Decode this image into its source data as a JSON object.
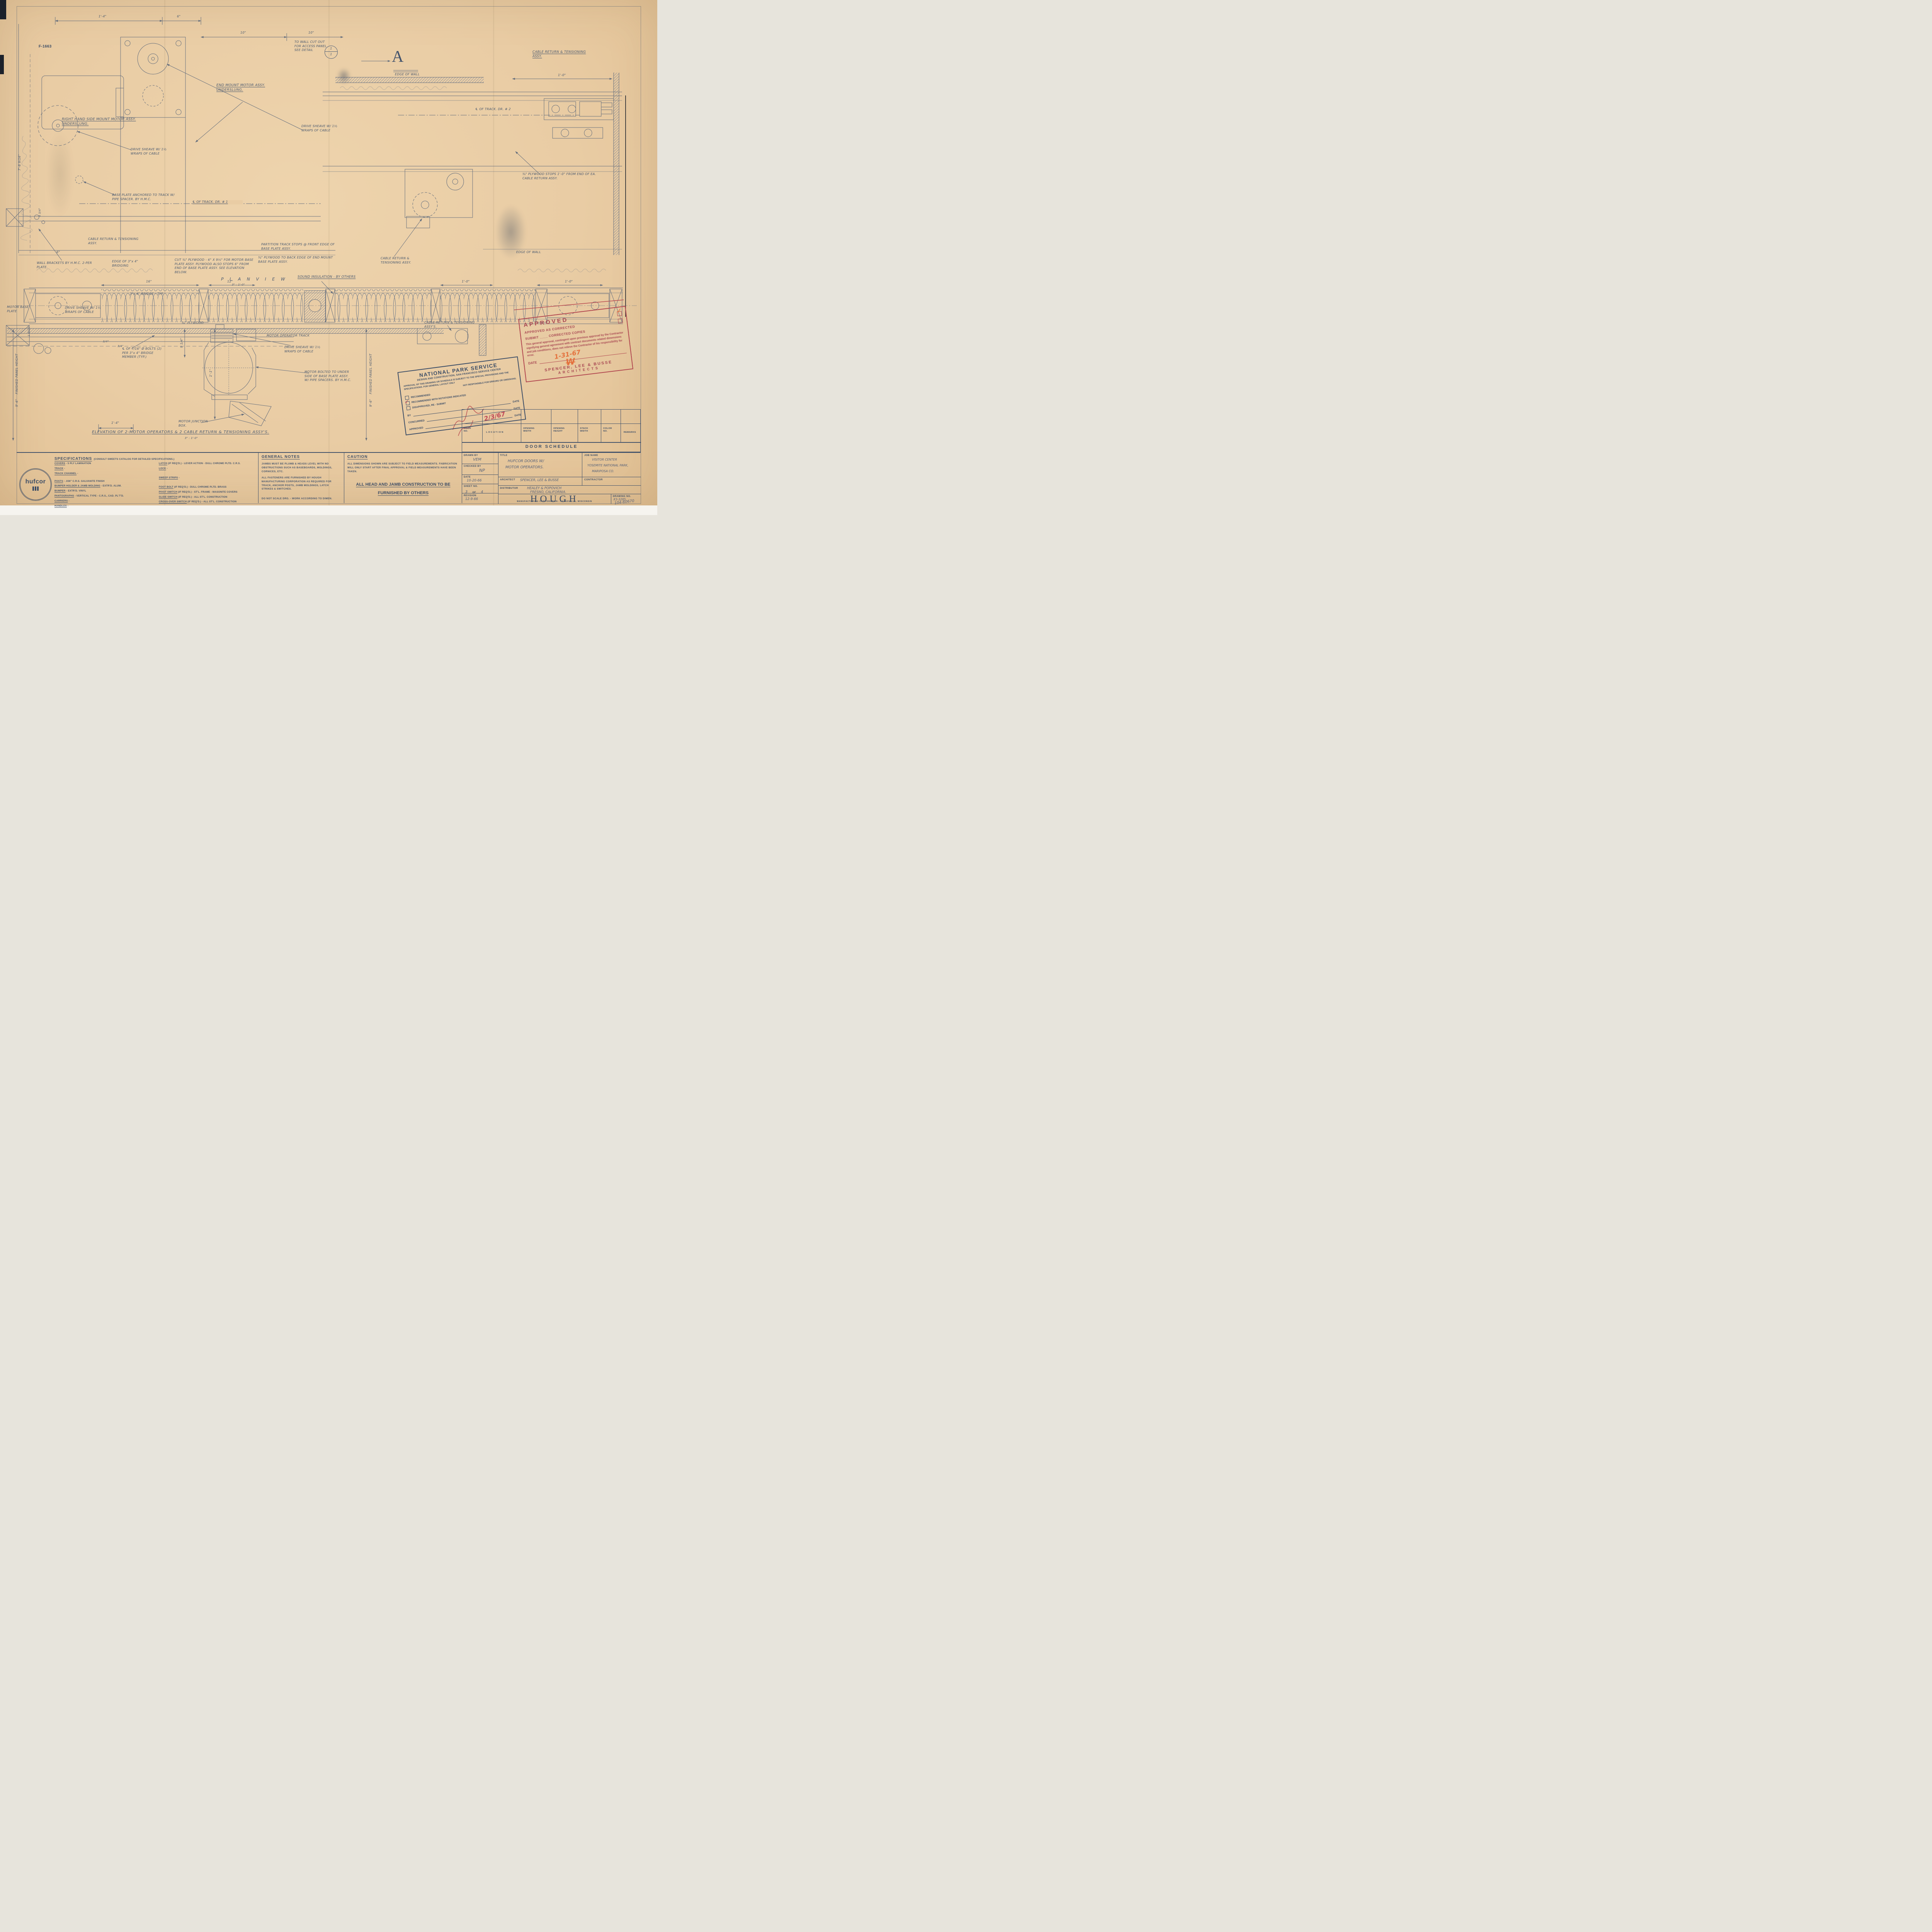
{
  "sheet": {
    "ref_no": "F-1663",
    "section_marker": "A",
    "detail_top": "1",
    "detail_bottom": "1"
  },
  "labels": {
    "rh_mount": "RIGHT HAND SIDE MOUNT MOTOR ASSY. UNDERSLUNG.",
    "end_mount": "END MOUNT MOTOR ASSY. UNDERSLUNG.",
    "wall_cutout": "TO WALL CUT OUT FOR ACCESS PANEL SEE DETAIL",
    "drive_sheave": "DRIVE SHEAVE W/ 1½ WRAPS OF CABLE",
    "edge_of_wall": "EDGE OF WALL",
    "cable_return": "CABLE RETURN & TENSIONING ASSY.",
    "cable_return_pl": "CABLE RETURN & TENSIONING ASSY'S.",
    "base_plate_anchor": "BASE PLATE ANCHORED TO TRACK W/ PIPE SPACER. BY H.M.C.",
    "track_cl1": "℄ OF TRACK. DR. # 1",
    "track_cl2": "℄ OF TRACK. DR. # 2",
    "wall_brackets": "WALL BRACKETS BY H.M.C. 2-PER PLATE.",
    "edge_bridging": "EDGE OF 3\"x 4\" BRIDGING",
    "cut_plywood": "CUT ¾\" PLYWOOD - 6\" X 9½\" FOR MOTOR BASE PLATE ASSY. PLYWOOD ALSO STOPS 6\" FROM END OF BASE PLATE ASSY. SEE ELEVATION BELOW.",
    "partition_stops": "PARTITION TRACK STOPS @ FRONT EDGE OF BASE PLATE ASSY.",
    "plywood_back": "¾\" PLYWOOD TO BACK EDGE OF END MOUNT BASE PLATE ASSY.",
    "plywood_stops": "¾\" PLYWOOD STOPS 1'-0\" FROM END OF EA. CABLE RETURN ASSY.",
    "sound_insulation": "SOUND INSULATION - BY OTHERS",
    "motor_base_plate": "MOTOR BASE PLATE",
    "bridge_typ": "3\"x 4\" BRIDGE - TYP.",
    "plywood34": "¾\" PLYWOOD",
    "bolts_note": "℄ OF 7/16\" Ø BOLTS (2) PER 3\"x 4\" BRIDGE MEMBER (TYP.)",
    "junction_box": "MOTOR JUNCTION BOX.",
    "motor_bolted": "MOTOR BOLTED TO UNDER SIDE OF BASE PLATE ASSY. W/ PIPE SPACERS. BY H.M.C.",
    "motor_track": "MOTOR OPERATOR TRACK",
    "finished_height": "FINISHED PANEL HEIGHT"
  },
  "dims": {
    "d1": "1'-4\"",
    "d2": "6\"",
    "d3": "10\"",
    "d4": "10\"",
    "d5": "1'-0\"",
    "d6": "7'-8 9/16\"",
    "d7": "4 3/4\"",
    "d8": "6\"",
    "d9": "16\"",
    "d10": "12\"",
    "d11": "1'-0\"",
    "d12": "1'-0\"",
    "d13": "9 1/4\"",
    "d14": "1'-1\"",
    "d15": "1'-4\"",
    "d16": "1 9/16\"",
    "d17": "3/4\"",
    "d18": "3/4\"",
    "d19": "9'-6\"",
    "d20": "9'-6\""
  },
  "plan_view": {
    "title": "P L A N    V I E W",
    "scale": "3\" : 1'-0\""
  },
  "elevation": {
    "title": "ELEVATION OF 2-MOTOR OPERATORS & 2 CABLE RETURN & TENSIONING ASSY'S.",
    "scale": "3\" : 1'-0\""
  },
  "nps_stamp": {
    "title": "NATIONAL PARK SERVICE",
    "subtitle": "DESIGN AND CONSTRUCTION, SAN FRANCISCO SERVICE CENTER",
    "body1": "APPROVAL OF THIS DRAWING OR SCHEDULE IS SUBJECT TO THE SPECIAL PROVISIONS AND THE SPECIFICATIONS.   FOR GENERAL LAYOUT ONLY",
    "body2": "NOT RESPONSIBLE FOR ERRORS OR OMISSIONS.",
    "cb1": "RECOMMENDED",
    "cb2": "RECOMMENDED WITH NOTATIONS INDICATED",
    "cb3": "DISAPPROVED, RE - SUBMIT",
    "by_label": "BY",
    "date_label": "DATE",
    "concurred_label": "CONCURRED",
    "approved_label": "APPROVED",
    "red_date": "2/3/67"
  },
  "approval_stamp": {
    "approved": "APPROVED",
    "as_corrected": "APPROVED AS CORRECTED",
    "submit": "SUBMIT ____ CORRECTED COPIES",
    "body": "This general approval, contingent upon previous approval by the Contractor signifying general agreement with contract documents related dimensions and job conditions, does not relieve the Contractor of his responsibility for error.",
    "date_label": "DATE",
    "date_value": "1-31-67",
    "initials": "W",
    "firm": "SPENCER, LEE & BUSSE",
    "firm2": "ARCHITECTS"
  },
  "door_schedule": {
    "title": "DOOR SCHEDULE",
    "col_door": "DOOR\nNO.",
    "col_location": "LOCATION",
    "col_ow": "OPENING\nWIDTH",
    "col_oh": "OPENING\nHEIGHT",
    "col_sw": "STACK\nWIDTH",
    "col_color": "COLOR\nNO.",
    "col_remarks": "REMARKS"
  },
  "title_block": {
    "drawn_by_label": "DRAWN BY",
    "drawn_by": "VEM",
    "checked_by_label": "CHECKED BY",
    "checked_by": "NP",
    "date_label": "DATE",
    "date": "10-20-66",
    "sheet_label": "SHEET NO.",
    "sheet_a": "3",
    "sheet_of": "OF",
    "sheet_b": "4",
    "revision_label": "REVISION",
    "revision": "12-9-66",
    "title_label": "TITLE",
    "title1": "HUFCOR DOORS W/",
    "title2": "MOTOR OPERATORS.",
    "job_label": "JOB NAME",
    "job1": "VISITOR CENTER",
    "job2": "YOSEMITE NATIONAL PARK,",
    "job3": "MARIPOSA CO.",
    "architect_label": "ARCHITECT",
    "architect": "SPENCER, LEE & BUSSE",
    "contractor_label": "CONTRACTOR",
    "distributor_label": "DISTRIBUTOR",
    "distributor1": "HEALEY & POPOVICH",
    "distributor2": "FRESNO, CALIFORNIA.",
    "company": "HOUGH",
    "company_sub": "MANUFACTURING CORPORATION - JANESVILLE, WISCONSIN",
    "drawing_no_label": "DRAWING NO.",
    "drawing_no1": "K3-3285",
    "drawing_no2": "104-60670"
  },
  "brand": {
    "logo": "hufcor"
  },
  "specifications": {
    "heading": "SPECIFICATIONS",
    "heading_note": "(CONSULT SWEETS CATALOG FOR DETAILED SPECIFICATIONS.)",
    "left": [
      {
        "t": "COVERS",
        "d": "- 5 PLY LAMINATION"
      },
      {
        "t": "TRACK",
        "d": "-"
      },
      {
        "t": "TRACK CHANNEL",
        "d": "-"
      },
      {
        "t": "POSTS",
        "d": "- .036\" C.R.S. GALVANITE FINISH"
      },
      {
        "t": "BUMPER HOLDER & JAMB MOLDING",
        "d": "- EXTR'D. ALUM."
      },
      {
        "t": "BUMPER",
        "d": "- EXTR'D. VINYL"
      },
      {
        "t": "PANTOGRAPHS",
        "d": "- VERTICAL TYPE - C.R.S., CAD. PL'T'D."
      },
      {
        "t": "CARRIERS",
        "d": "-"
      },
      {
        "t": "HANDLES",
        "d": "-"
      }
    ],
    "right": [
      {
        "t": "LATCH",
        "d": "(IF REQ'D.) - LEVER ACTION - DULL CHROME PLTD. C.R.S."
      },
      {
        "t": "LOCK",
        "d": "-"
      },
      {
        "t": "SWEEP STRIPS",
        "d": "-"
      },
      {
        "t": "FOOT BOLT",
        "d": "(IF REQ'D.) - DULL CHROME PLTD. BRASS"
      },
      {
        "t": "PIVOT SWITCH",
        "d": "(IF REQ'D.) - ST'L. FRAME - MASONITE COVERS"
      },
      {
        "t": "GLIDE SWITCH",
        "d": "(IF REQ'D.) - ALL ST'L. CONSTRUCTION"
      },
      {
        "t": "CROSS-OVER SWITCH",
        "d": "(IF REQ'D.) - ALL ST'L. CONSTRUCTION"
      }
    ]
  },
  "general_notes": {
    "heading": "GENERAL NOTES",
    "p1": "JAMBS MUST BE PLUMB & HEADS LEVEL WITH NO OBSTRUCTIONS SUCH AS BASEBOARDS, MOLDINGS, CORNICES,    ETC.",
    "p2": "ALL FASTENERS ARE FURNISHED BY HOUGH MANUFACTURING CORPORATION AS REQUIRED FOR TRACK, ANCHOR POSTS, JAMB MOLDINGS, LATCH STRIKES & SWITCHES.",
    "p3": "DO NOT SCALE DRG. - WORK ACCORDING TO DIMEN."
  },
  "caution": {
    "heading": "CAUTION",
    "p1": "ALL DIMENSIONS SHOWN ARE SUBJECT TO FIELD MEASUREMENTS. FABRICATION WILL ONLY START AFTER FINAL APPROVAL & FIELD MEASUREMENTS HAVE BEEN TAKEN.",
    "big1": "ALL HEAD AND JAMB CONSTRUCTION TO BE",
    "big2": "FURNISHED BY OTHERS"
  }
}
